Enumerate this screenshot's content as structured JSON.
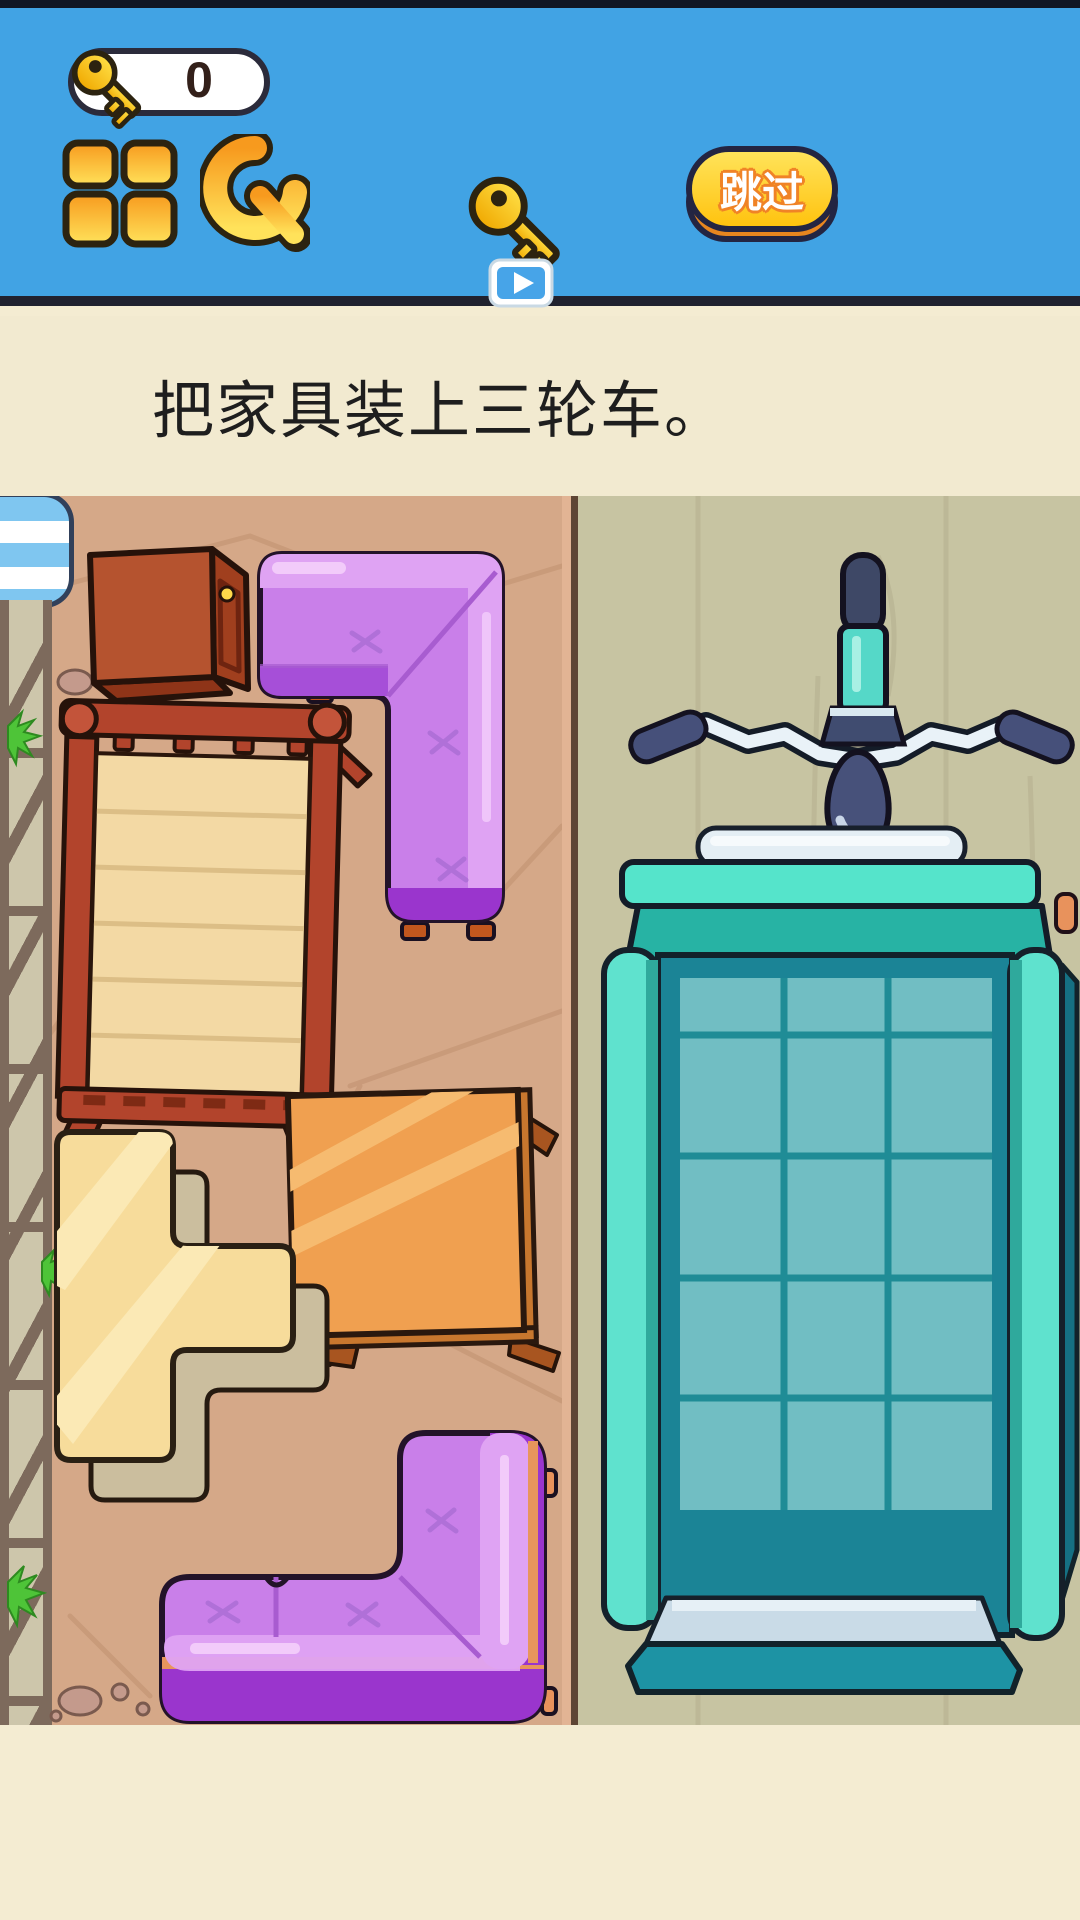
{
  "header": {
    "key_counter": {
      "icon": "key-icon",
      "count": "0"
    },
    "menu_button": {
      "icon": "grid-icon"
    },
    "restart_button": {
      "icon": "refresh-icon"
    },
    "free_key_button": {
      "icon": "key-play-icon"
    },
    "skip_button": {
      "label": "跳过"
    }
  },
  "instruction": {
    "title": "把家具装上三轮车。"
  },
  "game": {
    "left_zone": {
      "furniture": [
        "cabinet",
        "corner-sofa-top",
        "bed",
        "table",
        "t-cabinet",
        "corner-sofa-bottom"
      ]
    },
    "right_zone": {
      "target": "tricycle-cart"
    }
  },
  "colors": {
    "header_blue": "#41A3E4",
    "panel_cream": "#F2EAD0",
    "floor_left_tan": "#D5A888",
    "floor_right_khaki": "#C7C4A2",
    "accent_gold": "#FFD21E",
    "skip_yellow": "#FFC30F",
    "sofa_purple": "#C97FE9",
    "cart_teal": "#5FE2CE",
    "wood_red": "#B2442C",
    "table_orange": "#F0A050",
    "shelf_cream": "#F7DC9B",
    "seat_navy": "#47517A"
  }
}
